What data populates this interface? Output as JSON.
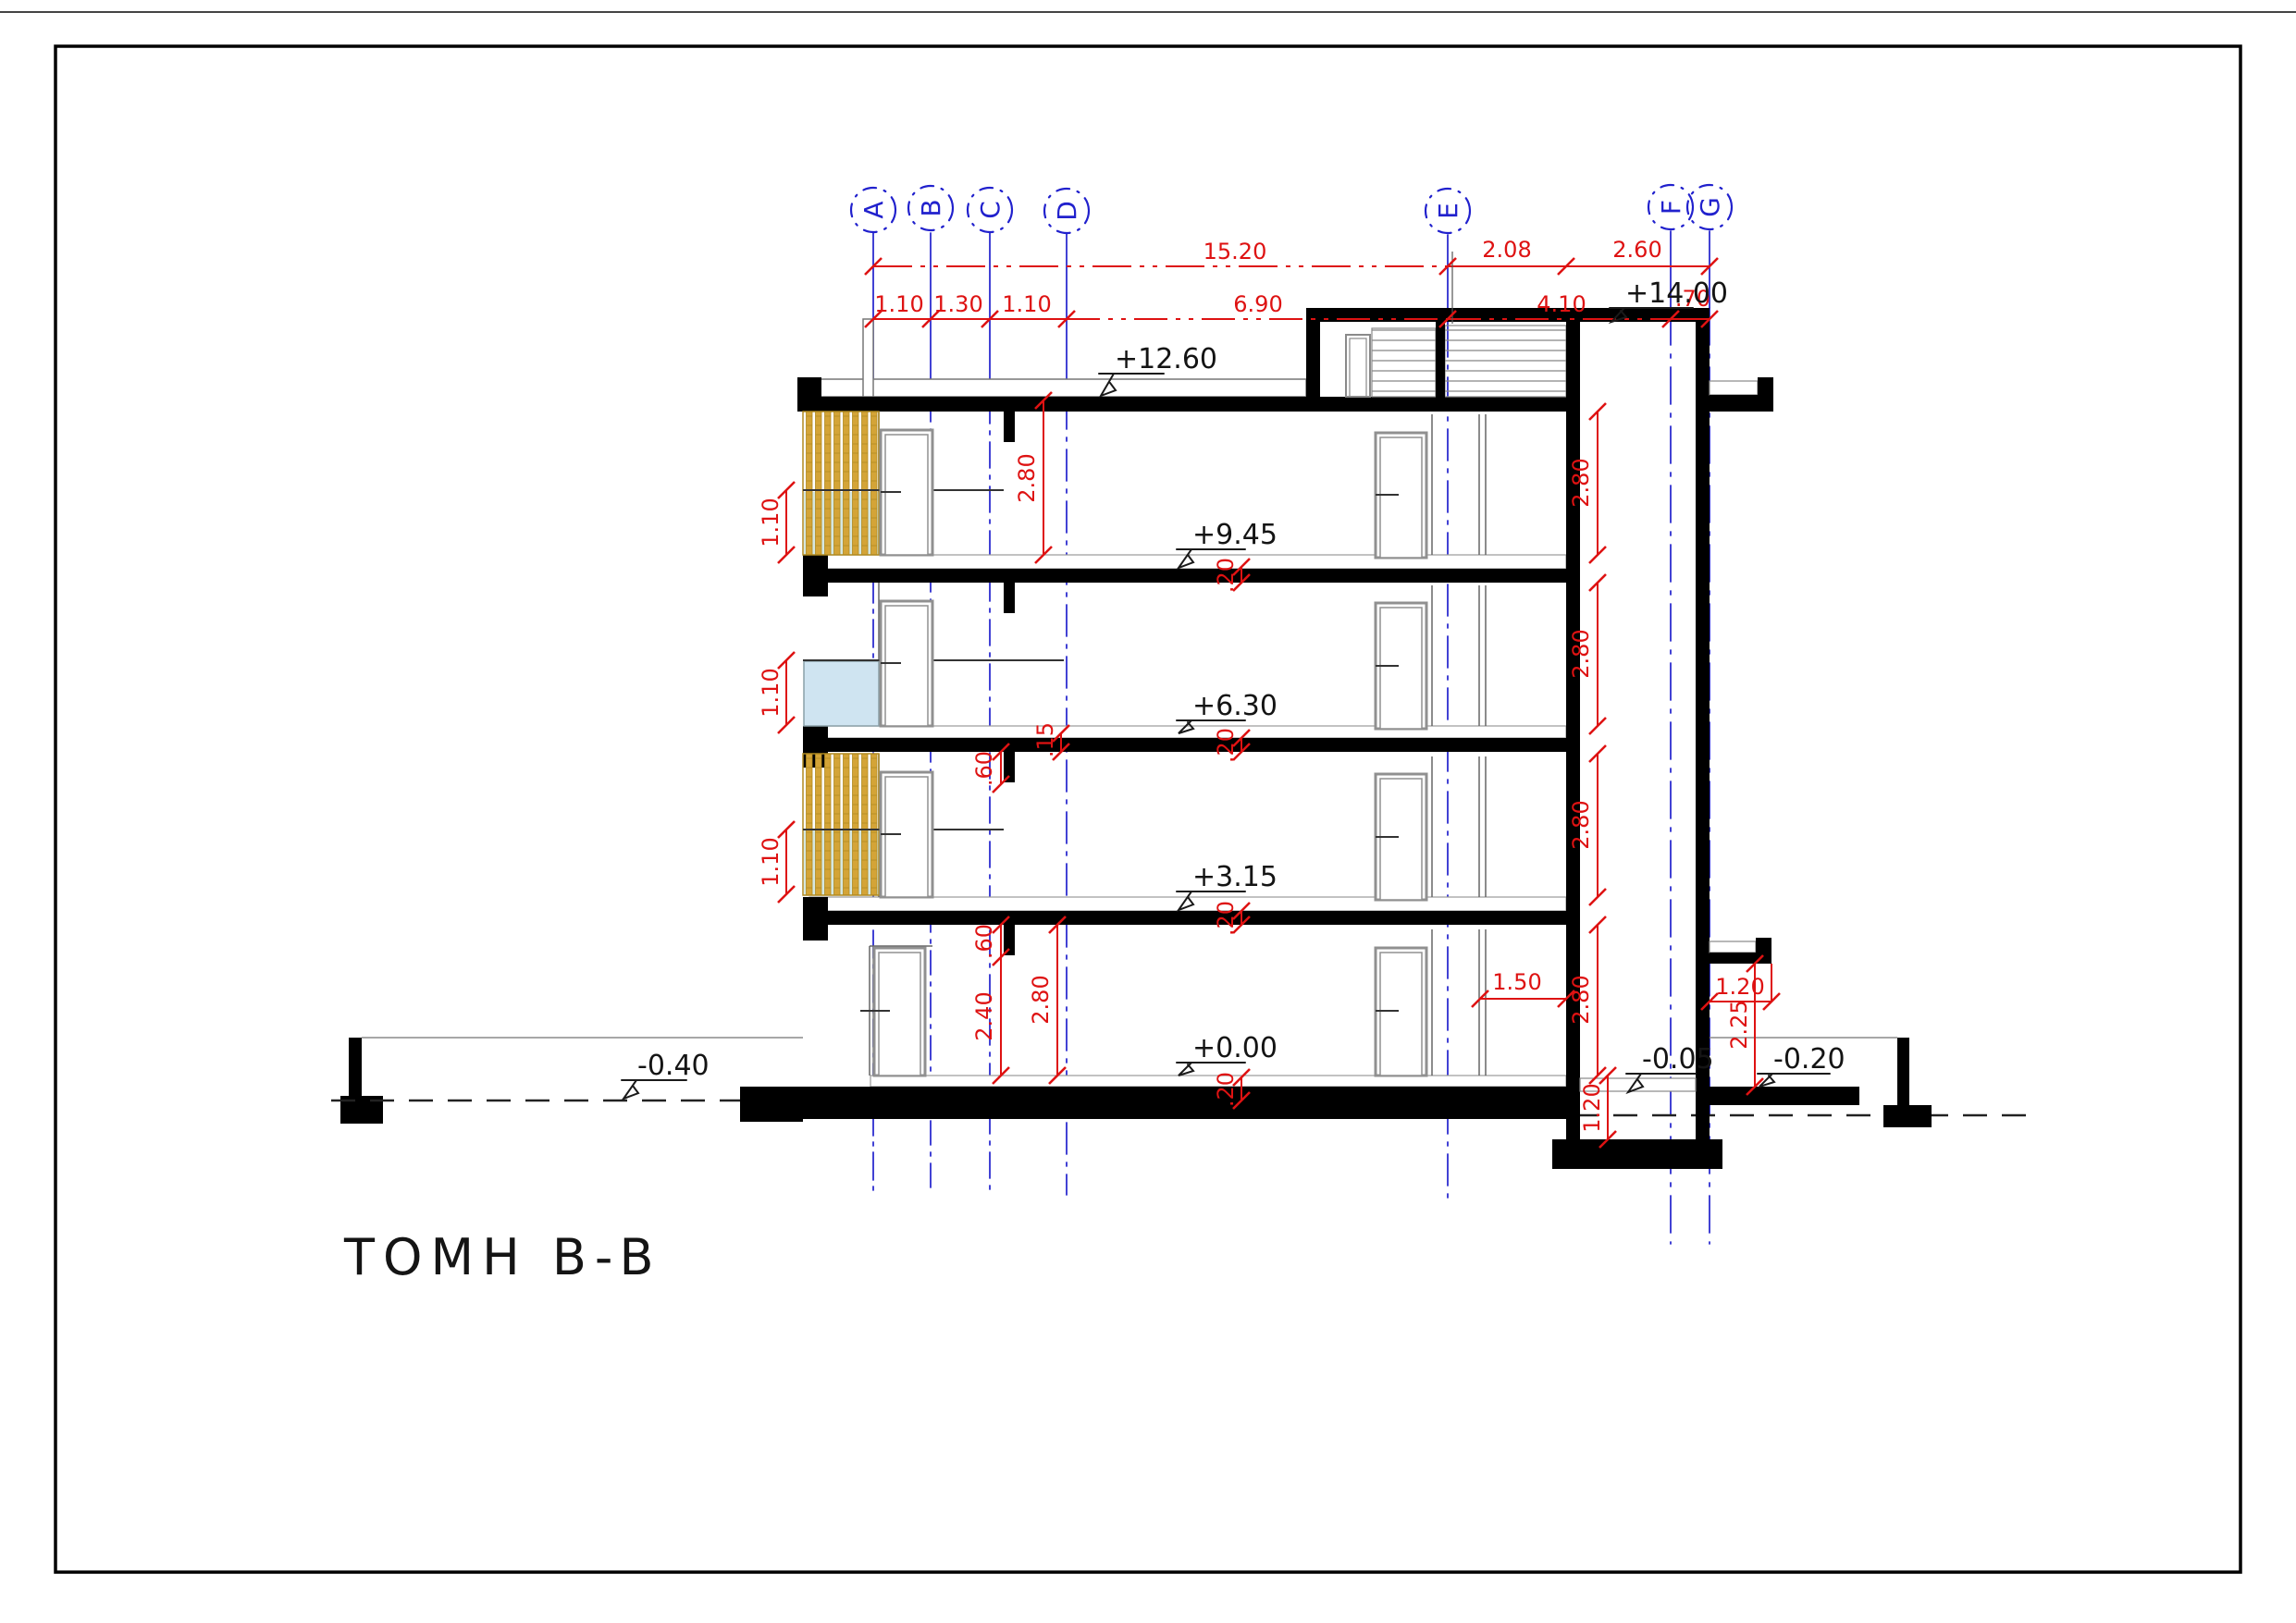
{
  "title": "ΤΟΜΗ B-B",
  "axes": [
    "A",
    "B",
    "C",
    "D",
    "E",
    "F",
    "G"
  ],
  "dims": {
    "row1": [
      "15.20",
      "2.08",
      "2.60"
    ],
    "row2": [
      "1.10",
      "1.30",
      "1.10",
      "6.90",
      "4.10",
      ".70"
    ],
    "left_floor_height": "2.80",
    "shaft_floors": [
      "2.80",
      "2.80",
      "2.80",
      "2.80"
    ],
    "railings": [
      "1.10",
      "1.10",
      "1.10"
    ],
    "beams": [
      ".60",
      ".60"
    ],
    "slab15": ".15",
    "slab20": [
      ".20",
      ".20",
      ".20",
      ".20"
    ],
    "under_beam": "2.40",
    "ground_height": "2.80",
    "entrance": "1.50",
    "canopy_w": "1.20",
    "canopy_h": "2.25",
    "pit": "1.20"
  },
  "levels": {
    "top": "+14.00",
    "roof": "+12.60",
    "f3": "+9.45",
    "f2": "+6.30",
    "f1": "+3.15",
    "ground": "+0.00",
    "yard_left": "-0.40",
    "pit": "-0.05",
    "yard_right": "-0.20"
  },
  "colors": {
    "axis_blue": "#2121cd",
    "dim_red": "#de1212",
    "wall_black": "#000000",
    "louver_gold": "#d4a437",
    "glass_blue": "#cfe4f1",
    "glass_tint": "#d5e7e0"
  }
}
